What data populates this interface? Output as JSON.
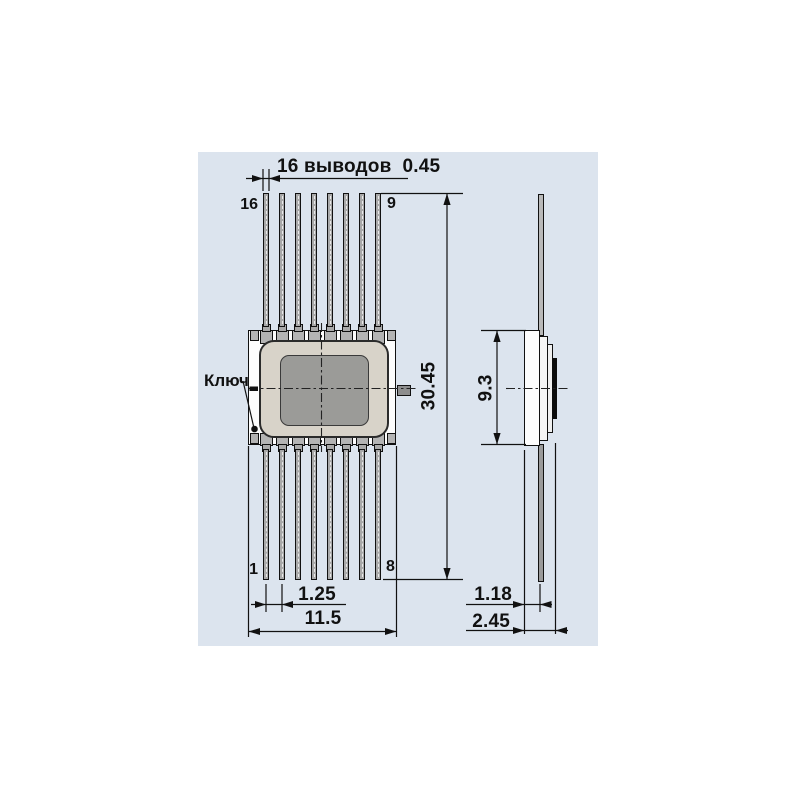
{
  "panel": {
    "background": "#dce4ee"
  },
  "front_view": {
    "leads_per_row": 8,
    "pin_top_left": "16",
    "pin_top_right": "9",
    "pin_bottom_left": "1",
    "pin_bottom_right": "8",
    "key_label": "Ключ"
  },
  "side_view": {
    "body_height": "9.3",
    "lead_standoff": "1.18",
    "overall_thickness": "2.45"
  },
  "dimensions": {
    "lead_count_label": "16 выводов",
    "lead_width": "0.45",
    "lead_pitch": "1.25",
    "row_width": "11.5",
    "overall_length": "30.45"
  },
  "colors": {
    "lead_metal": "#a9a9a9",
    "package_white": "#fdfdfd",
    "lid_beige": "#d8d3c9",
    "die_gray": "#9b9b98",
    "line": "#111111"
  }
}
